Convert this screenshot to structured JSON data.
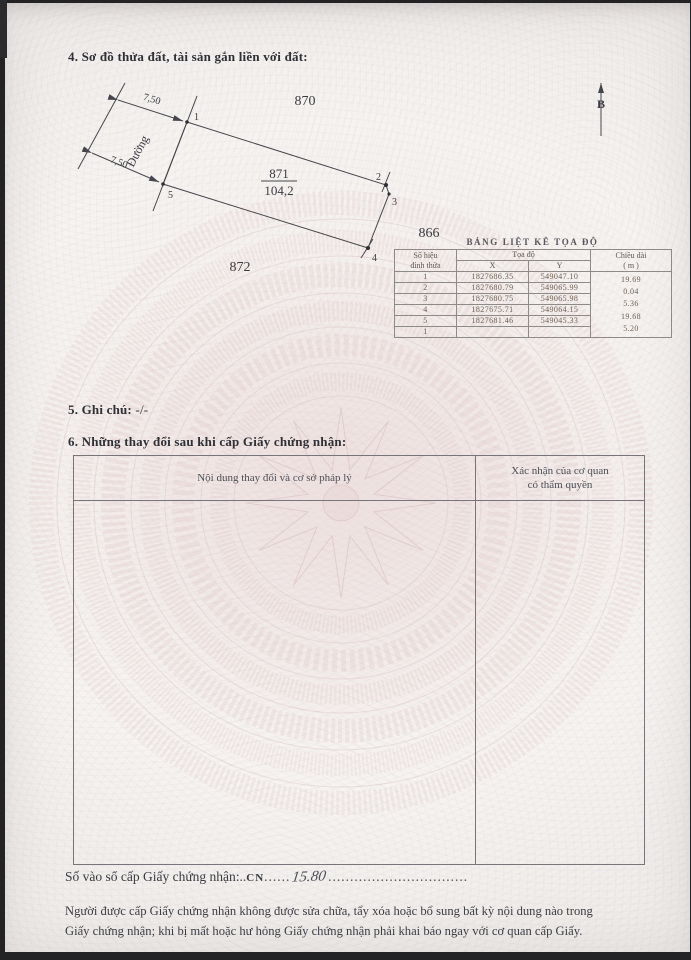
{
  "sections": {
    "s4_title": "4. Sơ đồ thửa đất, tài sản gắn liền với đất:",
    "s5_label": "5. Ghi chú:",
    "s5_value": " -/-",
    "s6_title": "6. Những thay đổi sau khi cấp Giấy chứng nhận:"
  },
  "diagram": {
    "north_label": "B",
    "road_label": "Đường",
    "dim_top": "7,50",
    "dim_bottom": "7,50",
    "parcel_number": "871",
    "parcel_area": "104,2",
    "neighbor_top": "870",
    "neighbor_bottom": "872",
    "neighbor_right": "866",
    "v1": "1",
    "v2": "2",
    "v3": "3",
    "v4": "4",
    "v5": "5"
  },
  "coord_table": {
    "title": "BẢNG LIỆT KÊ TỌA ĐỘ",
    "col_vertex_line1": "Số hiệu",
    "col_vertex_line2": "đỉnh thửa",
    "col_coords": "Tọa độ",
    "col_x": "X",
    "col_y": "Y",
    "col_length_line1": "Chiều dài",
    "col_length_line2": "( m )",
    "rows": [
      {
        "id": "1",
        "x": "1827686.35",
        "y": "549047.10"
      },
      {
        "id": "2",
        "x": "1827680.79",
        "y": "549065.99"
      },
      {
        "id": "3",
        "x": "1827680.75",
        "y": "549065.98"
      },
      {
        "id": "4",
        "x": "1827675.71",
        "y": "549064.15"
      },
      {
        "id": "5",
        "x": "1827681.46",
        "y": "549045.33"
      },
      {
        "id": "1",
        "x": "",
        "y": ""
      }
    ],
    "lengths": [
      "19.69",
      "0.04",
      "5.36",
      "19.68",
      "5.20"
    ]
  },
  "changes_table": {
    "col1_header": "Nội dung thay đổi và cơ sở pháp lý",
    "col2_header_line1": "Xác nhận của cơ quan",
    "col2_header_line2": "có thẩm quyền"
  },
  "registry": {
    "label": "Số vào sổ cấp Giấy chứng nhận:..",
    "code": "CN",
    "dots1": "......",
    "handwritten": "15.80",
    "dots2": "................................"
  },
  "footer": {
    "line1": "Người được cấp Giấy chứng nhận không được sửa chữa, tẩy xóa hoặc bổ sung bất kỳ nội dung nào trong",
    "line2": "Giấy chứng nhận; khi bị mất hoặc hư hỏng Giấy chứng nhận phải khai báo ngay với cơ quan cấp Giấy."
  },
  "colors": {
    "paper": "#f5f2f0",
    "pattern_pink": "#d9bcbc",
    "ink": "#3a3b41",
    "table_border": "#8d8a88"
  }
}
